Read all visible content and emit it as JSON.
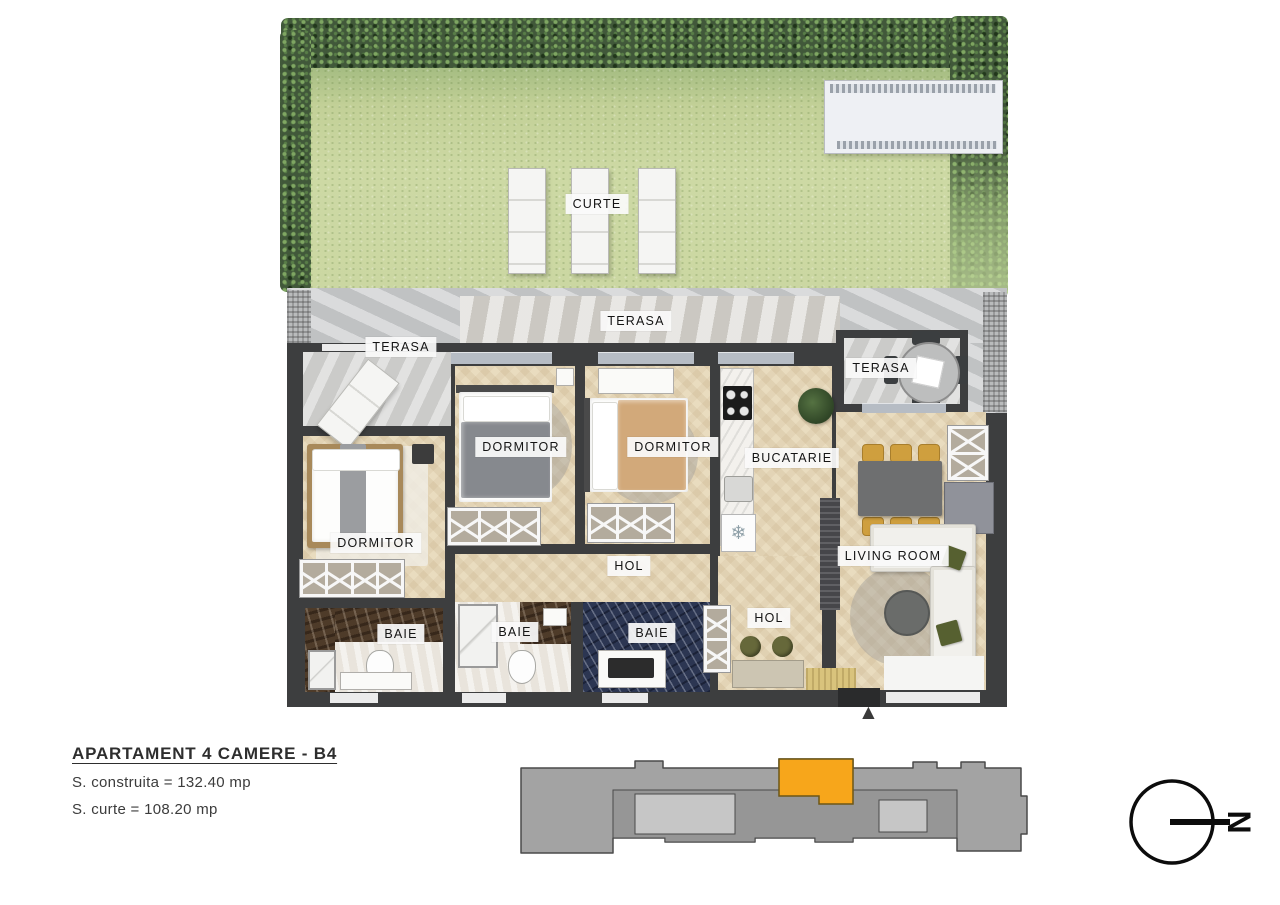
{
  "labels": {
    "curte": "CURTE",
    "terasa_left": "TERASA",
    "terasa_mid": "TERASA",
    "terasa_right": "TERASA",
    "dormitor_left": "DORMITOR",
    "dormitor_mid": "DORMITOR",
    "dormitor_right": "DORMITOR",
    "bucatarie": "BUCATARIE",
    "living": "LIVING ROOM",
    "hol_mid": "HOL",
    "hol_right": "HOL",
    "baie_left": "BAIE",
    "baie_mid": "BAIE",
    "baie_right": "BAIE"
  },
  "info": {
    "title": "APARTAMENT 4 CAMERE - B4",
    "area_built": "S. construita = 132.40 mp",
    "area_yard": "S. curte = 108.20 mp"
  },
  "compass": {
    "letter": "N"
  },
  "icons": {
    "snowflake": "❄",
    "entrance_arrow": "▲"
  },
  "colors": {
    "unit_highlight": "#F7A61B",
    "building_gray": "#A3A3A3",
    "wall": "#3D3E3F",
    "wood_floor": "#E9DCBF",
    "grass": "#CDD9A4",
    "hedge": "#41583A",
    "bath_navy": "#2C3652",
    "bath_brown": "#4E3B29"
  }
}
